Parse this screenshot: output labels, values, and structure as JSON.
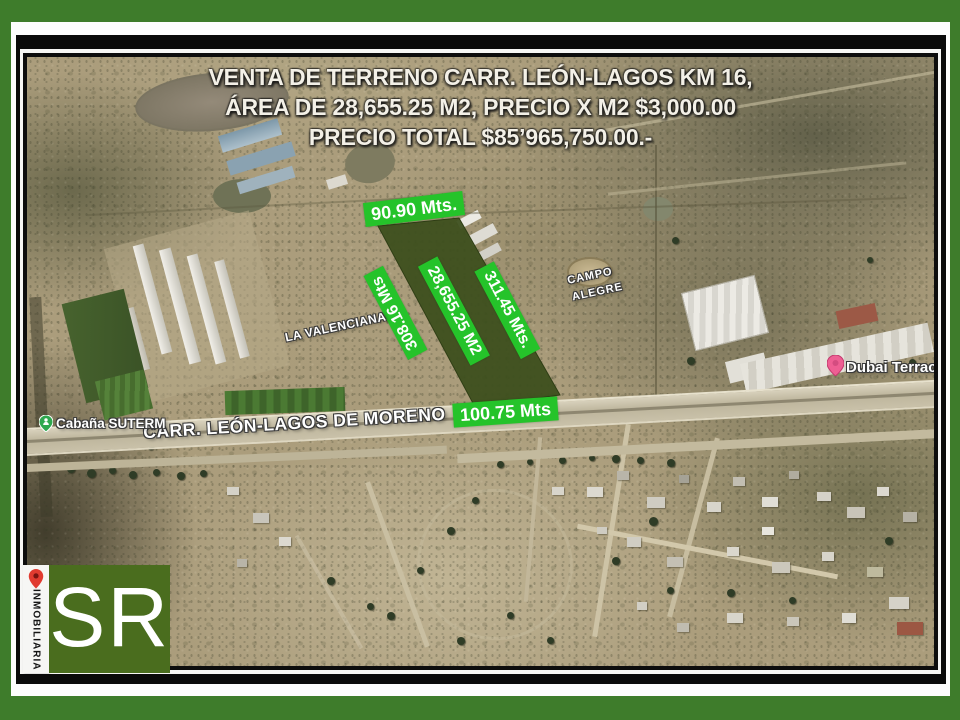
{
  "title": {
    "line1": "VENTA DE TERRENO CARR. LEÓN-LAGOS KM 16,",
    "line2": "ÁREA DE 28,655.25 M2, PRECIO X M2 $3,000.00",
    "line3": "PRECIO TOTAL $85’965,750.00.-"
  },
  "measurements": {
    "top": "90.90 Mts.",
    "left": "308.16 Mts",
    "area": "28,655.25 M2",
    "right": "311.45 Mts.",
    "bottom": "100.75 Mts"
  },
  "places": {
    "road": "CARR. LEÓN-LAGOS DE MORENO",
    "valenciana": "LA VALENCIANA",
    "campo_line1": "CAMPO",
    "campo_line2": "ALEGRE",
    "cabana": "Cabaña SUTERM",
    "dubai": "Dubai Terrac"
  },
  "logo": {
    "vertical_text": "INMOBILIARIA",
    "initials": "SR"
  },
  "colors": {
    "frame_green": "#3e7c2b",
    "label_green": "#25c32a",
    "parcel_green": "#3d4f1d",
    "logo_green": "#4a6d1e",
    "title_text": "#f3f0e7",
    "pin_red": "#e13b30",
    "pin_pink": "#ee5f93",
    "pin_green": "#2fa84f"
  }
}
